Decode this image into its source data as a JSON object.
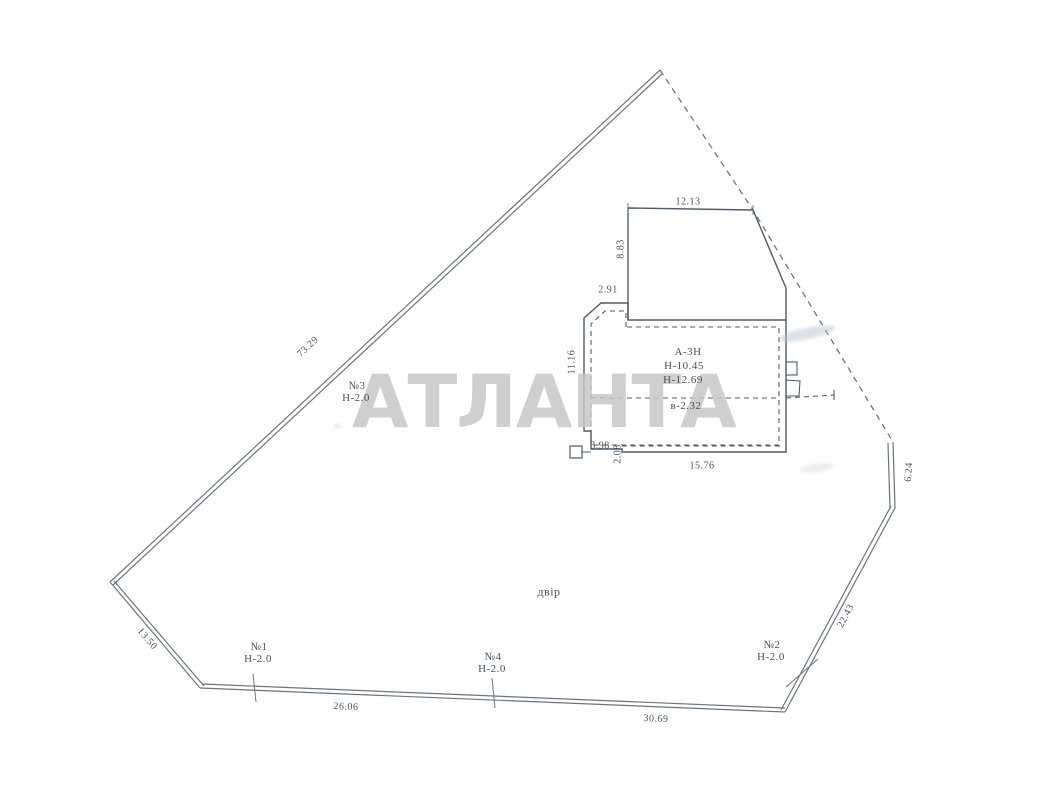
{
  "document": {
    "type_note": "scanned cadastral site plan",
    "line_color": "#6a7580",
    "building_line_color": "#4f5b67",
    "text_color": "#46525e",
    "watermark_color": "#c7c7c7"
  },
  "watermark": {
    "text": "АТЛАНТА"
  },
  "yard": {
    "label": "двір"
  },
  "building": {
    "designation": "А-3Н",
    "heights": [
      "Н-10.45",
      "Н-12.69",
      "в-2.32"
    ]
  },
  "boundary_dimensions": [
    "73.29",
    "13.50",
    "26.06",
    "30.69",
    "22.43",
    "6.24"
  ],
  "building_dimensions": [
    "12.13",
    "8.83",
    "2.91",
    "11.16",
    "3.98",
    "2.08",
    "15.76"
  ],
  "fences": [
    {
      "number": "№1",
      "height": "Н-2.0"
    },
    {
      "number": "№2",
      "height": "Н-2.0"
    },
    {
      "number": "№3",
      "height": "Н-2.0"
    },
    {
      "number": "№4",
      "height": "Н-2.0"
    }
  ],
  "labels": [
    {
      "name": "dim-boundary-73-29",
      "text": "73.29",
      "x": 308,
      "y": 347,
      "rot": -43,
      "size": 10
    },
    {
      "name": "dim-boundary-13-50",
      "text": "13.50",
      "x": 147,
      "y": 639,
      "rot": 50,
      "size": 10
    },
    {
      "name": "dim-boundary-26-06",
      "text": "26.06",
      "x": 346,
      "y": 707,
      "rot": 2,
      "size": 10
    },
    {
      "name": "dim-boundary-30-69",
      "text": "30.69",
      "x": 656,
      "y": 719,
      "rot": 2,
      "size": 10
    },
    {
      "name": "dim-boundary-22-43",
      "text": "22.43",
      "x": 846,
      "y": 616,
      "rot": -62,
      "size": 10
    },
    {
      "name": "dim-boundary-6-24",
      "text": "6.24",
      "x": 909,
      "y": 472,
      "rot": -86,
      "size": 10
    },
    {
      "name": "dim-building-12-13",
      "text": "12.13",
      "x": 688,
      "y": 202,
      "rot": 0,
      "size": 10
    },
    {
      "name": "dim-building-8-83",
      "text": "8.83",
      "x": 621,
      "y": 249,
      "rot": -90,
      "size": 10
    },
    {
      "name": "dim-building-2-91",
      "text": "2.91",
      "x": 608,
      "y": 290,
      "rot": 0,
      "size": 10
    },
    {
      "name": "dim-building-11-16",
      "text": "11.16",
      "x": 572,
      "y": 362,
      "rot": -90,
      "size": 10
    },
    {
      "name": "dim-building-3-98",
      "text": "3.98",
      "x": 600,
      "y": 446,
      "rot": 0,
      "size": 10
    },
    {
      "name": "dim-building-2-08",
      "text": "2.08",
      "x": 618,
      "y": 454,
      "rot": -90,
      "size": 10
    },
    {
      "name": "dim-building-15-76",
      "text": "15.76",
      "x": 702,
      "y": 466,
      "rot": 0,
      "size": 10
    },
    {
      "name": "building-designation",
      "text": "А-3Н",
      "x": 688,
      "y": 352,
      "rot": 0,
      "size": 11
    },
    {
      "name": "building-height-overall",
      "text": "Н-10.45",
      "x": 684,
      "y": 366,
      "rot": 0,
      "size": 11
    },
    {
      "name": "building-height-ridge",
      "text": "Н-12.69",
      "x": 683,
      "y": 380,
      "rot": 0,
      "size": 11
    },
    {
      "name": "building-height-eaves",
      "text": "в-2.32",
      "x": 686,
      "y": 406,
      "rot": 0,
      "size": 11
    },
    {
      "name": "fence-3-number",
      "text": "№3",
      "x": 357,
      "y": 386,
      "rot": 0,
      "size": 11
    },
    {
      "name": "fence-3-height",
      "text": "Н-2.0",
      "x": 356,
      "y": 398,
      "rot": 0,
      "size": 11
    },
    {
      "name": "fence-1-number",
      "text": "№1",
      "x": 259,
      "y": 647,
      "rot": 0,
      "size": 11
    },
    {
      "name": "fence-1-height",
      "text": "Н-2.0",
      "x": 258,
      "y": 659,
      "rot": 0,
      "size": 11
    },
    {
      "name": "fence-4-number",
      "text": "№4",
      "x": 493,
      "y": 657,
      "rot": 0,
      "size": 11
    },
    {
      "name": "fence-4-height",
      "text": "Н-2.0",
      "x": 492,
      "y": 669,
      "rot": 0,
      "size": 11
    },
    {
      "name": "fence-2-number",
      "text": "№2",
      "x": 772,
      "y": 645,
      "rot": 0,
      "size": 11
    },
    {
      "name": "fence-2-height",
      "text": "Н-2.0",
      "x": 771,
      "y": 657,
      "rot": 0,
      "size": 11
    },
    {
      "name": "yard-label",
      "text": "двір",
      "x": 549,
      "y": 592,
      "rot": 0,
      "size": 12
    }
  ]
}
